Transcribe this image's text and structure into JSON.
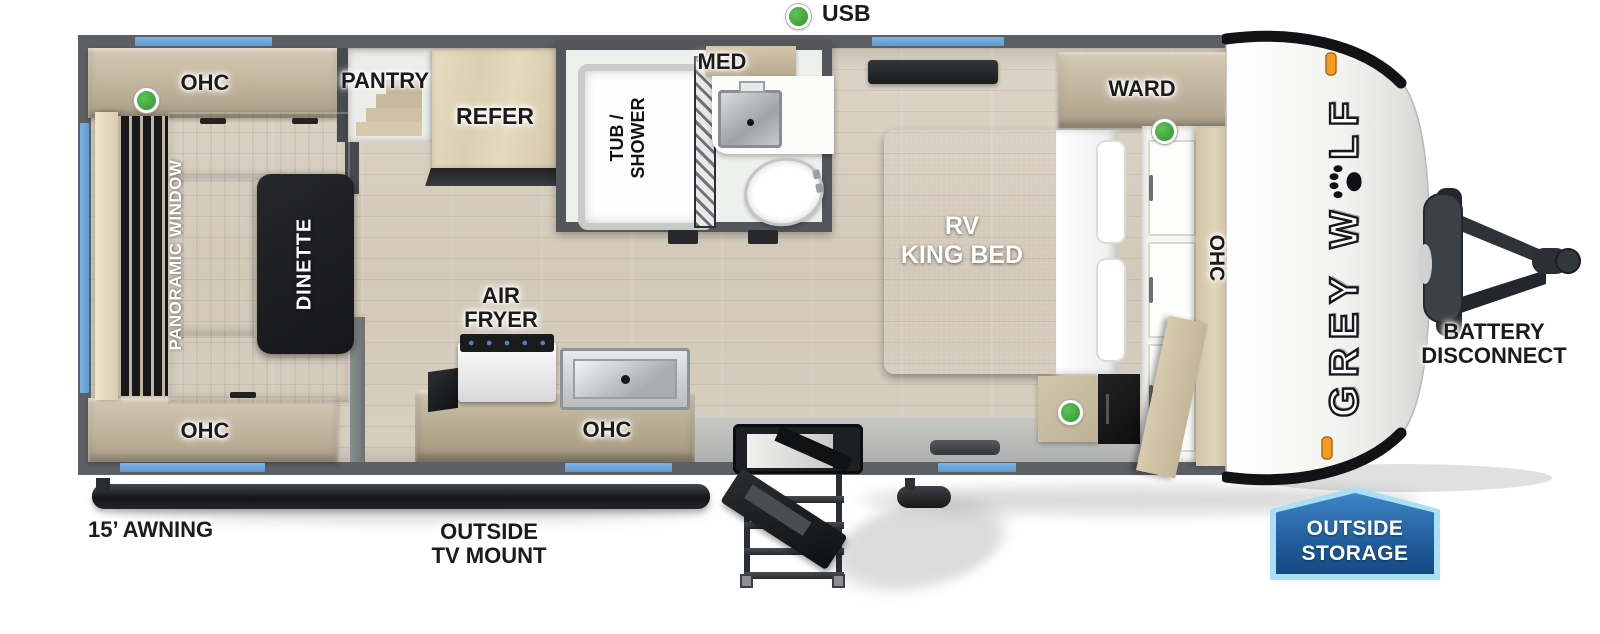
{
  "callouts": {
    "usb": "USB",
    "awning": "15’ AWNING",
    "tv_mount_line1": "OUTSIDE",
    "tv_mount_line2": "TV MOUNT",
    "battery_line1": "BATTERY",
    "battery_line2": "DISCONNECT",
    "storage_line1": "OUTSIDE",
    "storage_line2": "STORAGE"
  },
  "rear_living": {
    "ohc_top": "OHC",
    "ohc_bottom": "OHC",
    "panoramic_window": "PANORAMIC WINDOW",
    "dinette": "DINETTE",
    "pantry": "PANTRY",
    "refer": "REFER"
  },
  "kitchen": {
    "air_fryer_line1": "AIR",
    "air_fryer_line2": "FRYER",
    "ohc": "OHC"
  },
  "bathroom": {
    "tub_line1": "TUB /",
    "tub_line2": "SHOWER",
    "med": "MED"
  },
  "bedroom": {
    "bed_line1": "RV",
    "bed_line2": "KING BED",
    "ward": "WARD",
    "ohc": "OHC"
  },
  "brand": {
    "prefix": "GREY W",
    "suffix": "LF"
  },
  "colors": {
    "window_blue": "#6aa9dc",
    "indicator_green": "#3aa838",
    "marker_orange": "#f59a23",
    "wall_gray": "#5c5f63",
    "badge_blue": "#1d5796",
    "badge_border": "#a9e0f5"
  }
}
